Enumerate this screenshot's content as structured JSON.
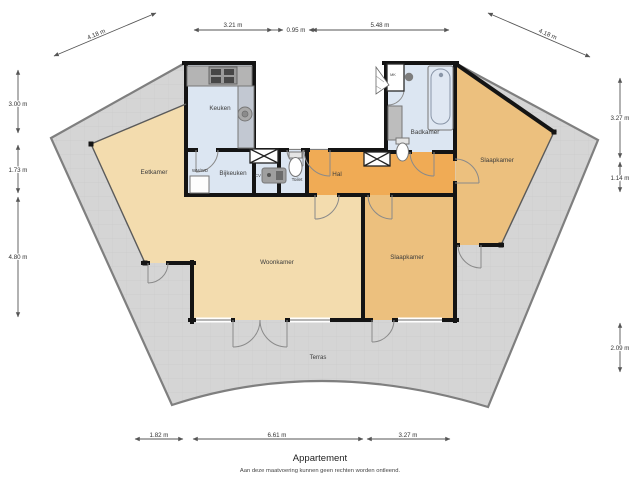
{
  "title": "Appartement",
  "disclaimer": "Aan deze maatvoering kunnen geen rechten worden ontleend.",
  "rooms": {
    "keuken": "Keuken",
    "eetkamer": "Eetkamer",
    "bijkeuken": "Bijkeuken",
    "wmwd": "WM/WD",
    "cv": "CV",
    "toilet": "Toilet",
    "hal": "Hal",
    "badkamer": "Badkamer",
    "mk": "MK",
    "slaapkamer_rechts": "Slaapkamer",
    "woonkamer": "Woonkamer",
    "slaapkamer_zuid": "Slaapkamer",
    "terras": "Terras"
  },
  "dimensions": {
    "top_diag_left": "4.18 m",
    "top_1": "3.21 m",
    "top_2": "0.95 m",
    "top_3": "5.48 m",
    "top_diag_right": "4.18 m",
    "left_1": "3.00 m",
    "left_2": "1.73 m",
    "left_3": "4.80 m",
    "right_1": "3.27 m",
    "right_2": "1.14 m",
    "right_3": "2.09 m",
    "bottom_1": "1.82 m",
    "bottom_2": "6.61 m",
    "bottom_3": "3.27 m"
  },
  "colors": {
    "living_cream": "#f3dcae",
    "bedroom_tan": "#ecc07e",
    "hall_orange": "#f0ab55",
    "wet_blue": "#dce6f2",
    "terrace_gray": "#d5d5d5",
    "terrace_border": "#7f7f7f",
    "wall_black": "#141414"
  }
}
